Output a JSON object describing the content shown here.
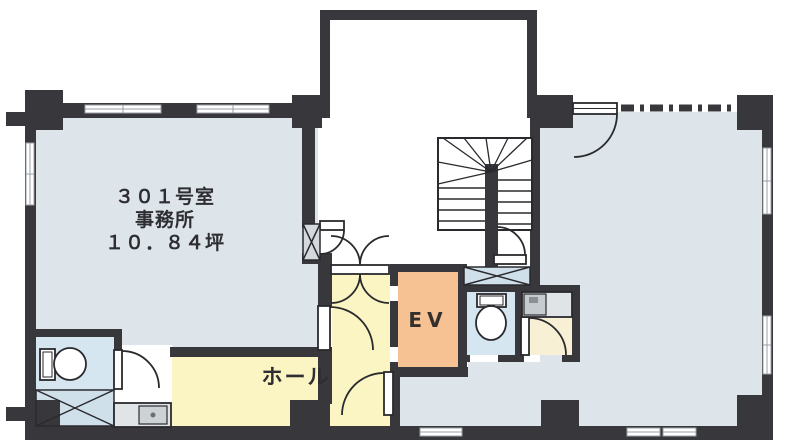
{
  "plan": {
    "room_301": {
      "number": "３０１号室",
      "use": "事務所",
      "area": "１０．８４坪"
    },
    "elevator": {
      "label": "EV"
    },
    "hall": {
      "label": "ホール"
    }
  },
  "colors": {
    "wall": "#38383c",
    "office_floor": "#dde5ea",
    "hall_floor": "#faf5c3",
    "elevator_fill": "#f6c193",
    "toilet_floor": "#d6e6f0",
    "washroom_floor": "#f7f0d4",
    "shaft_fill": "#cfe0ea",
    "counter_fill": "#e0e4e6",
    "line": "#2a2a2e",
    "window_stroke": "#9aa0a5",
    "background": "#ffffff"
  },
  "icons": {
    "toilet_left": "toilet-icon",
    "toilet_right": "toilet-icon",
    "sink_counter": "sink-icon",
    "kitchenette": "kitchenette-sink-icon",
    "staircase": "staircase-icon",
    "shaft": "x-shaft-icon",
    "door": "door-swing-arc",
    "partition": "dash-dot-partition"
  }
}
